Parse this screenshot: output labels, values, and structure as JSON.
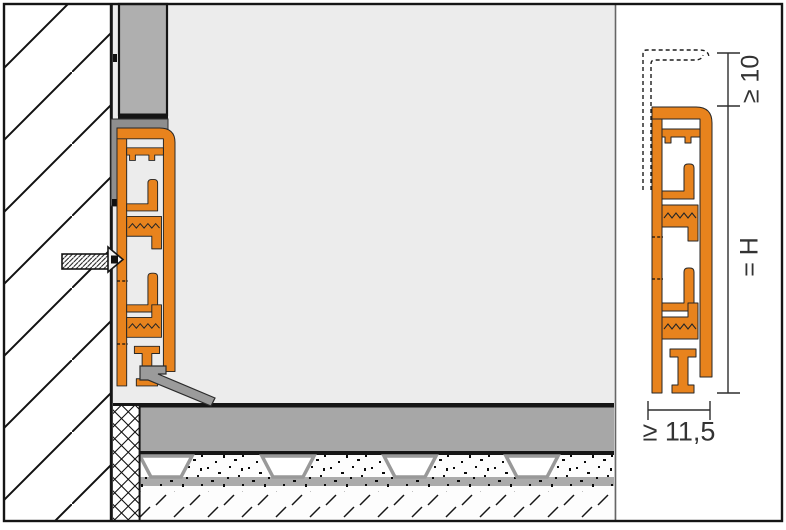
{
  "drawing": {
    "type": "technical-section-detail",
    "dimensions": {
      "top_offset": "≥ 10",
      "height": "= H",
      "width": "≥ 11,5"
    },
    "components": [
      "wall",
      "wall-covering-panel",
      "support-angle",
      "skirting-profile",
      "fixing-screw",
      "sealing-lip",
      "edge-insulation-strip",
      "screed",
      "studded-screed-panel",
      "concrete-substrate"
    ],
    "colors": {
      "profile_orange": "#E8831D",
      "panel_gray": "#AFAFAF",
      "screed_gray": "#A7A7A7",
      "angle_gray": "#8E8E8E",
      "seal_gray": "#9B9B9B",
      "background_gray": "#ECECEC",
      "line_black": "#161616"
    }
  }
}
